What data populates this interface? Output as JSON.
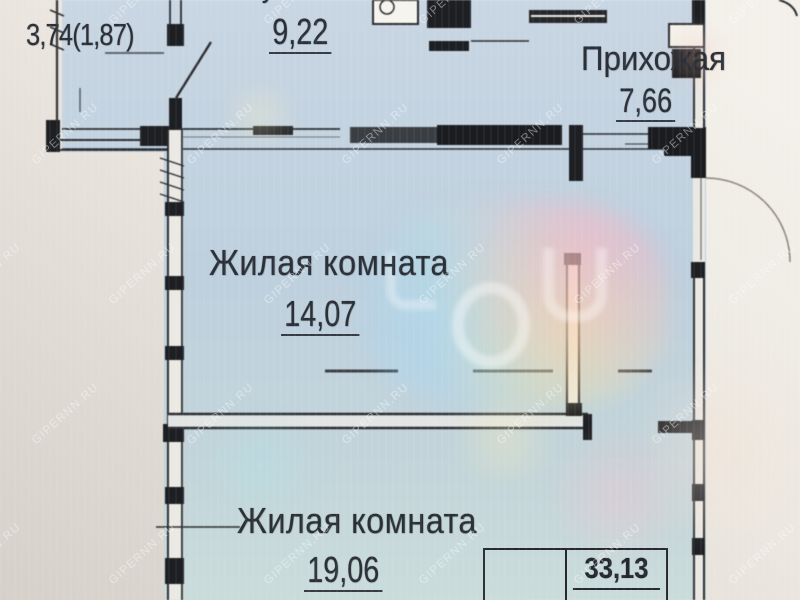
{
  "plan": {
    "rooms": {
      "balcony": {
        "area_label": "3,74(1,87)"
      },
      "kitchen": {
        "name": "Кухня",
        "area": "9,22"
      },
      "hallway": {
        "name": "Прихожая",
        "area": "7,66"
      },
      "living_room_1": {
        "name": "Жилая комната",
        "area": "14,07"
      },
      "living_room_2": {
        "name": "Жилая комната",
        "area": "19,06"
      }
    },
    "summary_table": {
      "total_area": "33,13"
    },
    "watermark_text": "GIPERNN.RU",
    "colors": {
      "plan_fill": "#c2d1df",
      "wall": "#26282c",
      "paper": "#ece8e0",
      "label_text": "#2b3038"
    }
  }
}
